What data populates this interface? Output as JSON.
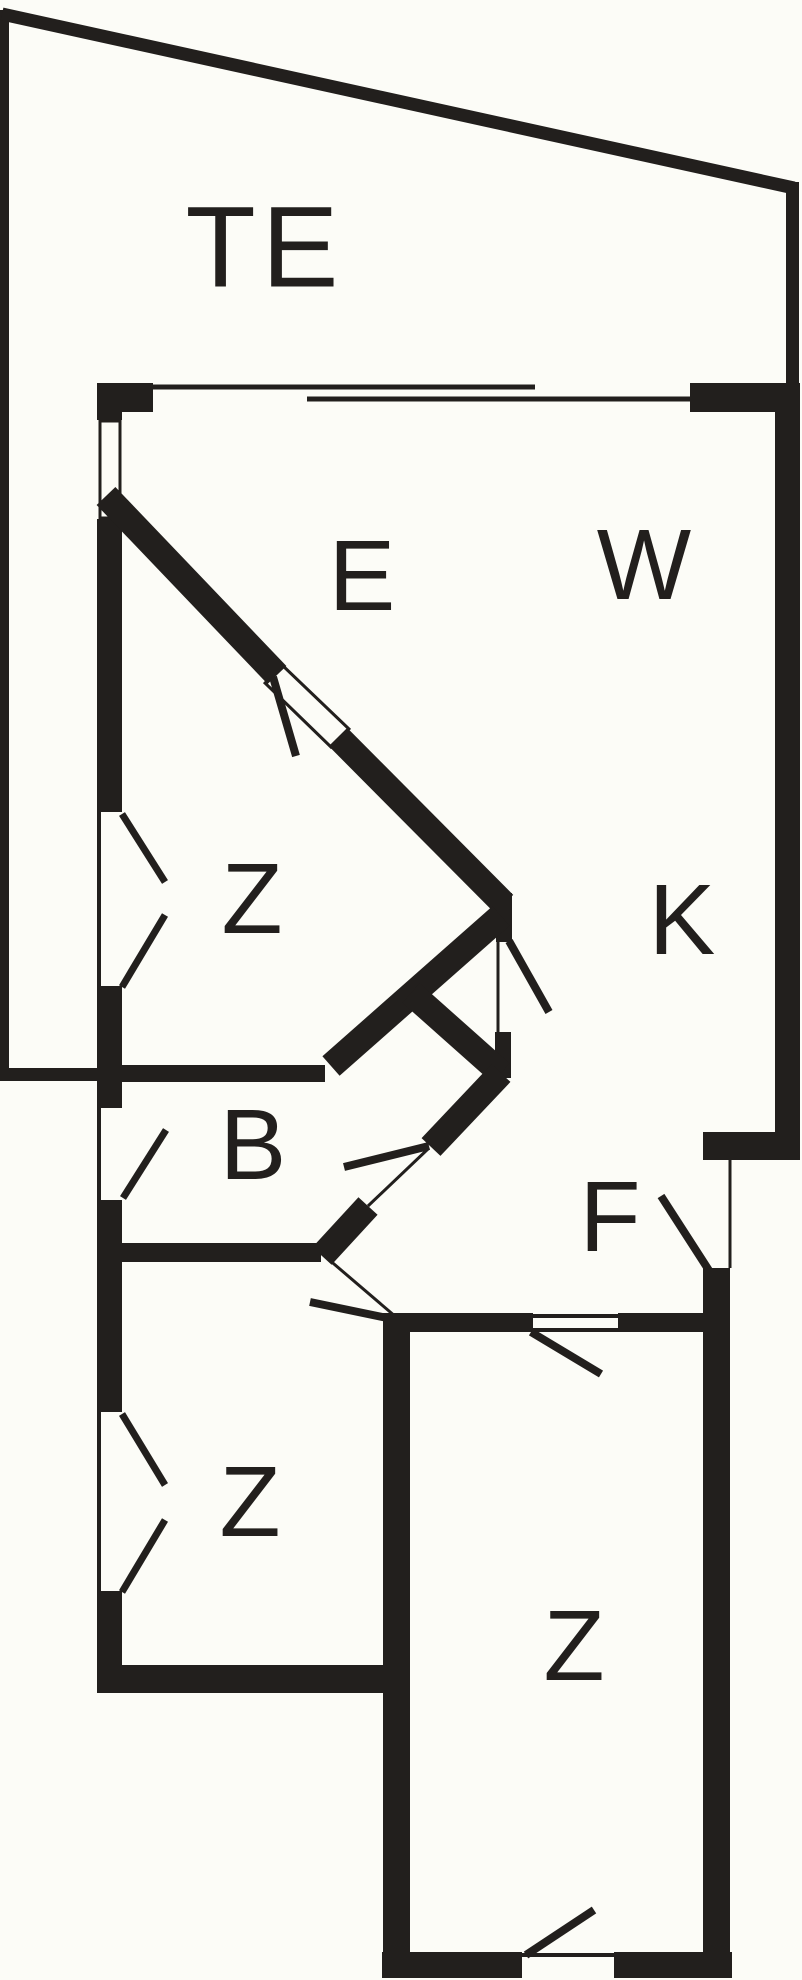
{
  "plan": {
    "background": "#fcfcf7",
    "wall_color": "#221f1d",
    "rooms": [
      {
        "id": "terrace",
        "label": "TE"
      },
      {
        "id": "dining-area",
        "label": "E"
      },
      {
        "id": "living-room",
        "label": "W"
      },
      {
        "id": "bedroom-upper-left",
        "label": "Z"
      },
      {
        "id": "kitchen",
        "label": "K"
      },
      {
        "id": "bathroom",
        "label": "B"
      },
      {
        "id": "hallway",
        "label": "F"
      },
      {
        "id": "bedroom-lower-left",
        "label": "Z"
      },
      {
        "id": "bedroom-lower-right",
        "label": "Z"
      }
    ]
  }
}
